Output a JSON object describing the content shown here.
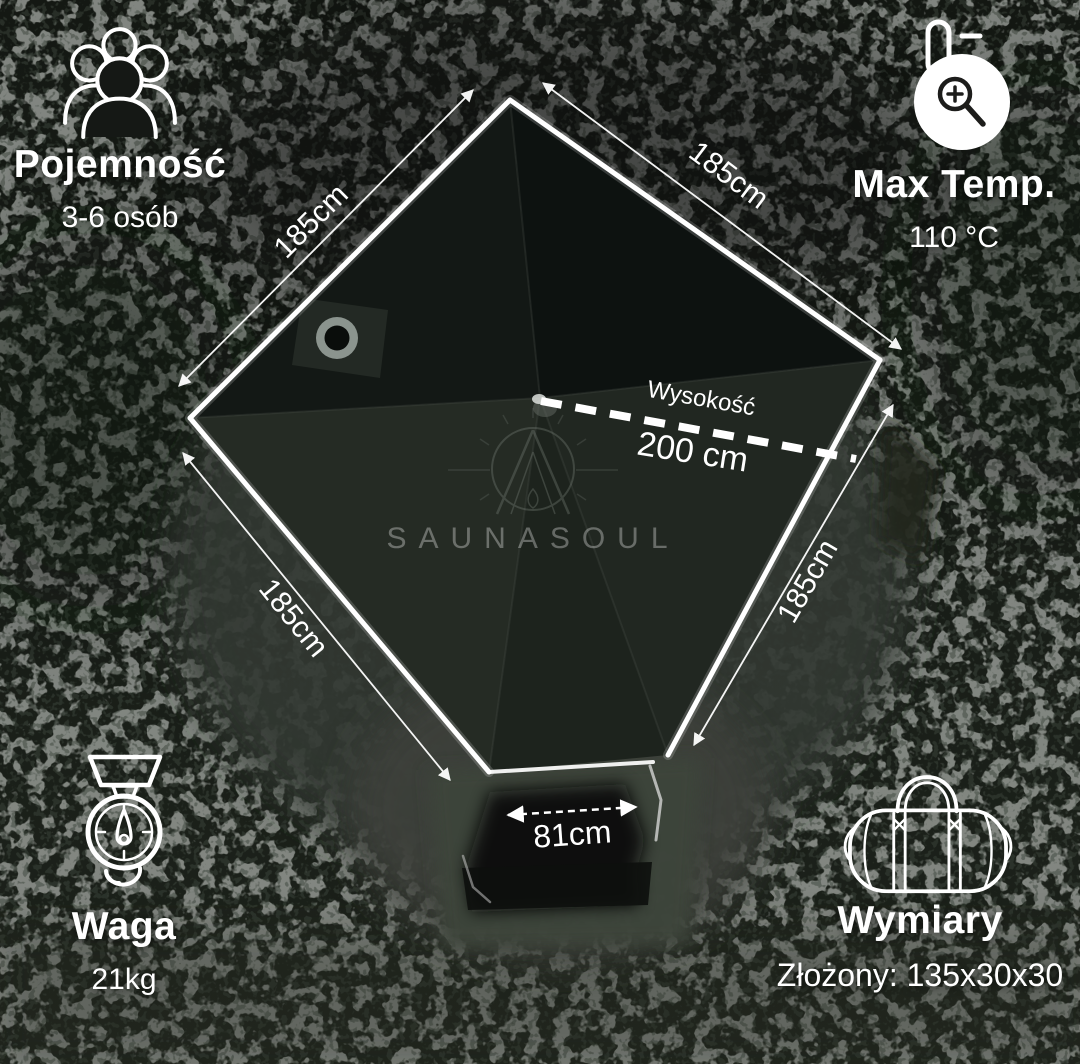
{
  "watermark": {
    "brand": "SAUNASOUL"
  },
  "features": {
    "capacity": {
      "title": "Pojemność",
      "value": "3-6 osób",
      "icon": "people-group-icon"
    },
    "max_temp": {
      "title": "Max Temp.",
      "value": "110 °C",
      "icon": "thermometer-magnifier-icon"
    },
    "weight": {
      "title": "Waga",
      "value": "21kg",
      "icon": "hanging-scale-icon"
    },
    "dimensions": {
      "title": "Wymiary",
      "value": "Złożony: 135x30x30",
      "icon": "duffel-bag-icon"
    }
  },
  "measurements": {
    "side_top_left": "185cm",
    "side_top_right": "185cm",
    "side_bottom_left": "185cm",
    "side_bottom_right": "185cm",
    "height_label": "Wysokość",
    "height_value": "200 cm",
    "door_width": "81cm"
  },
  "colors": {
    "line": "#ffffff",
    "text": "#ffffff",
    "speckle": "#4b504a",
    "tent_panel_dark": "#0d1210",
    "tent_wall": "#363c34"
  }
}
